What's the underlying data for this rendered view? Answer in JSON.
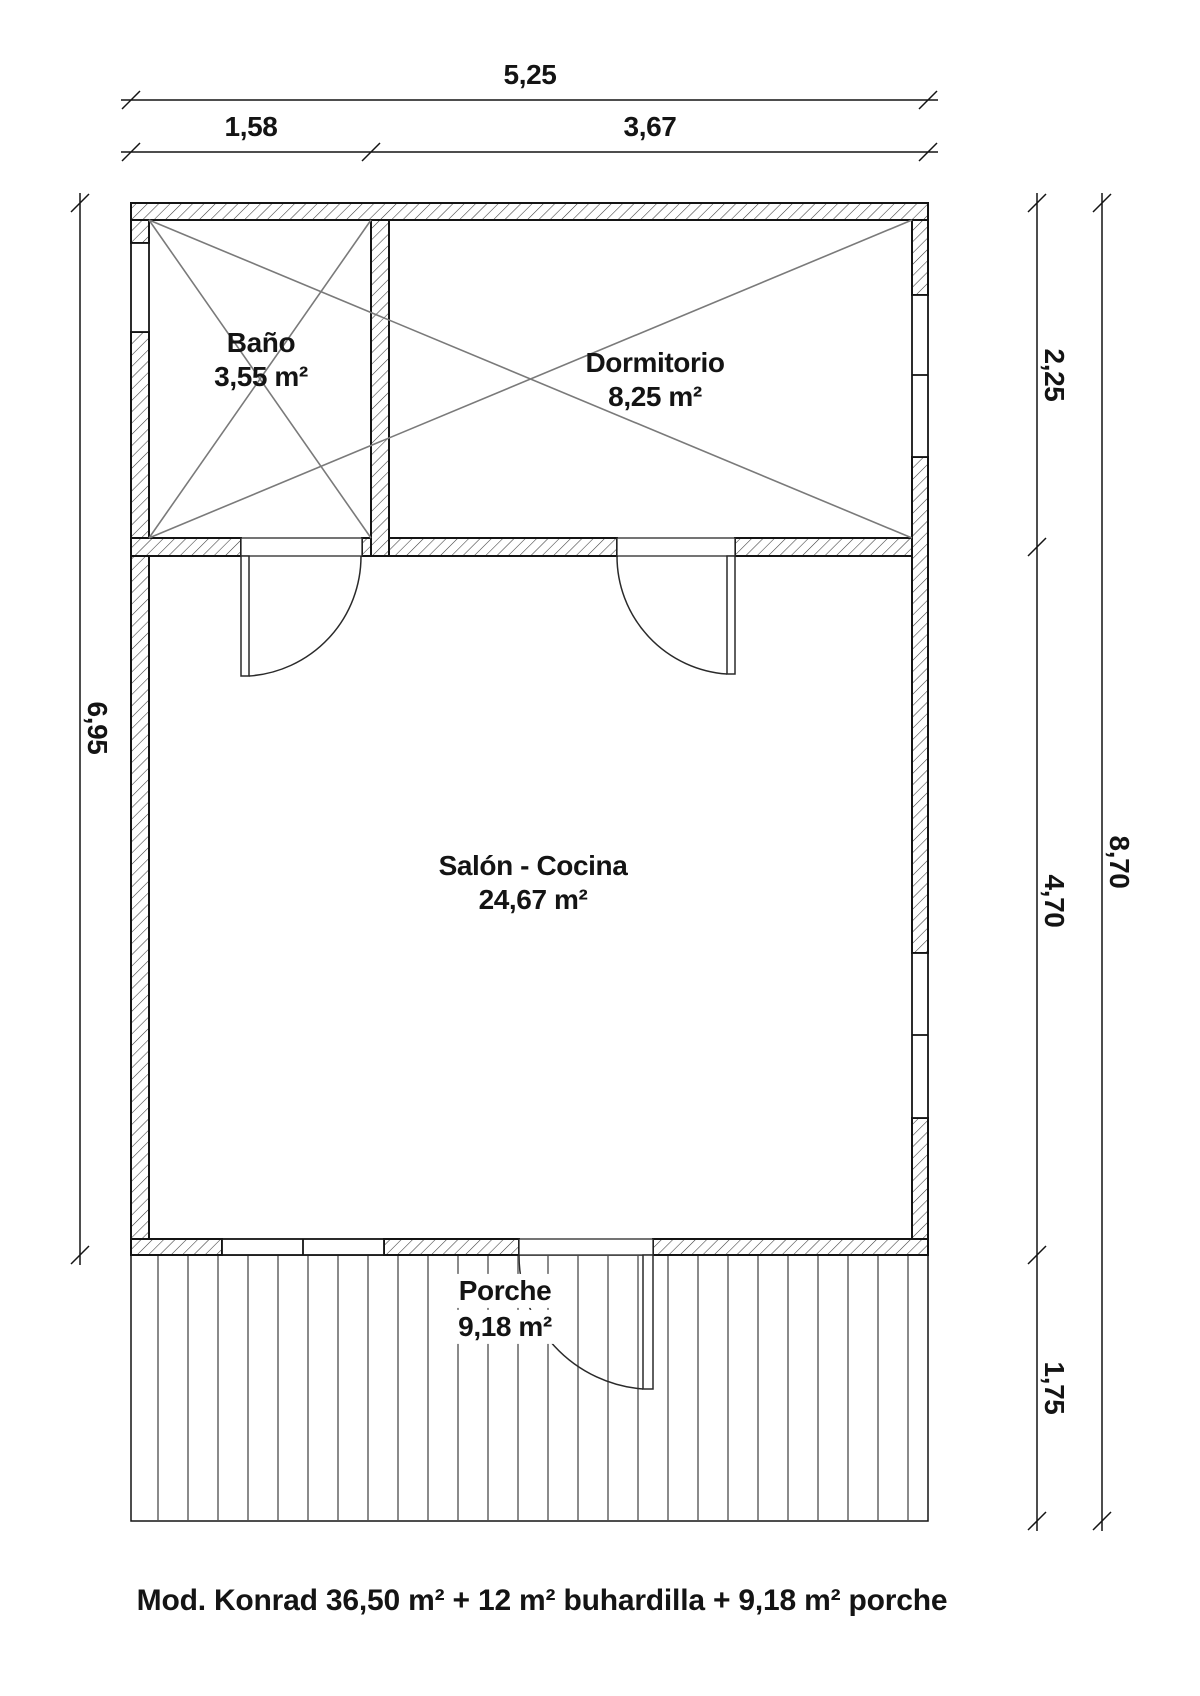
{
  "title": "Floor plan Mod. Konrad",
  "dimensions": {
    "top_total": "5,25",
    "top_left": "1,58",
    "top_right": "3,67",
    "left_total": "6,95",
    "right_top": "2,25",
    "right_middle": "4,70",
    "right_bottom": "1,75",
    "right_total": "8,70"
  },
  "rooms": {
    "bano": {
      "name": "Baño",
      "area": "3,55 m²"
    },
    "dormitorio": {
      "name": "Dormitorio",
      "area": "8,25 m²"
    },
    "salon": {
      "name": "Salón - Cocina",
      "area": "24,67 m²"
    },
    "porche": {
      "name": "Porche",
      "area": "9,18 m²"
    }
  },
  "caption": "Mod. Konrad 36,50 m² + 12 m² buhardilla + 9,18 m² porche",
  "colors": {
    "line": "#141414",
    "hatch": "#3a3a3a",
    "diagonal": "#7a7a7a",
    "deck_board": "#8a8a8a",
    "background": "#ffffff"
  }
}
